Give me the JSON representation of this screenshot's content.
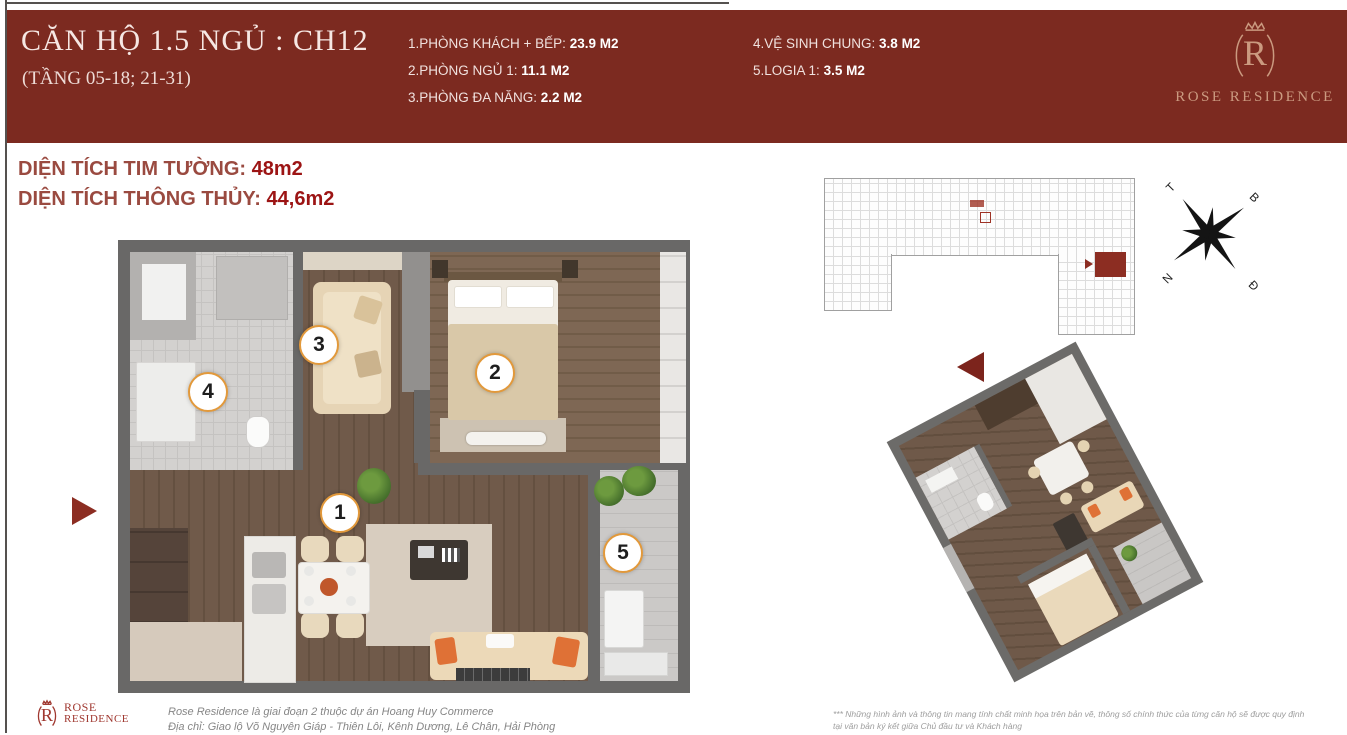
{
  "header": {
    "title": "CĂN HỘ 1.5 NGỦ : CH12",
    "subtitle": "(TẦNG 05-18; 21-31)",
    "rooms_col1": [
      {
        "label": "1.PHÒNG KHÁCH + BẾP:",
        "value": "23.9 M2"
      },
      {
        "label": "2.PHÒNG NGỦ 1:",
        "value": "11.1 M2"
      },
      {
        "label": "3.PHÒNG ĐA NĂNG:",
        "value": "2.2 M2"
      }
    ],
    "rooms_col2": [
      {
        "label": "4.VỆ SINH CHUNG:",
        "value": "3.8 M2"
      },
      {
        "label": "5.LOGIA 1:",
        "value": "3.5 M2"
      }
    ],
    "brand": "ROSE RESIDENCE"
  },
  "areas": {
    "tim_tuong_label": "DIỆN TÍCH TIM TƯỜNG:",
    "tim_tuong_value": "48m2",
    "thong_thuy_label": "DIỆN TÍCH THÔNG THỦY:",
    "thong_thuy_value": "44,6m2"
  },
  "floorplan": {
    "room_numbers": [
      "1",
      "2",
      "3",
      "4",
      "5"
    ]
  },
  "compass": {
    "t": "T",
    "b": "B",
    "n": "N",
    "d": "Đ"
  },
  "footer": {
    "brand_line1": "ROSE",
    "brand_line2": "RESIDENCE",
    "line1": "Rose Residence là giai đoạn 2 thuộc dự án Hoang Huy Commerce",
    "line2": "Địa chỉ: Giao lộ Võ Nguyên Giáp - Thiên Lôi, Kênh Dương, Lê Chân, Hải Phòng",
    "disclaimer_line1": "*** Những hình ảnh và thông tin mang tính chất minh họa trên bản vẽ, thông số chính thức của từng căn hộ sẽ được quy định",
    "disclaimer_line2": "tại văn bản ký kết giữa Chủ đầu tư và Khách hàng"
  },
  "colors": {
    "header_maroon": "#7c2a20",
    "value_red": "#9c1414",
    "highlight_red": "#8c2d22",
    "circle_orange": "#e2993b",
    "brand_gold": "#cb9a80"
  }
}
